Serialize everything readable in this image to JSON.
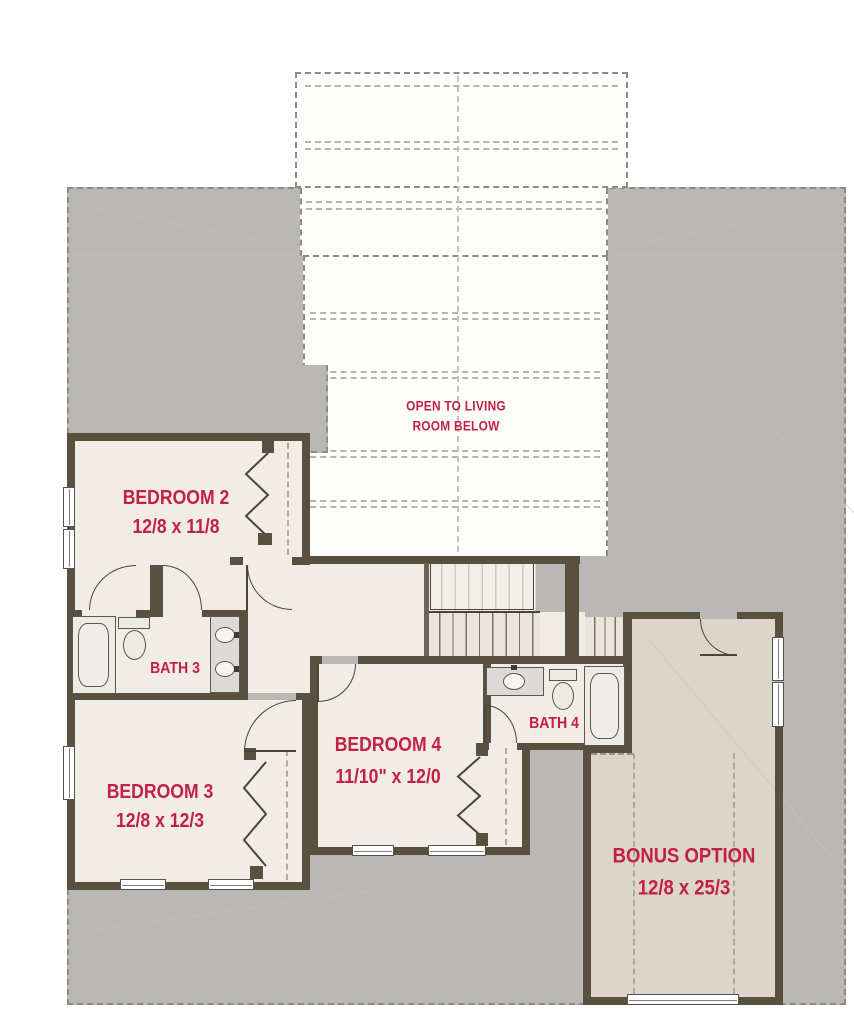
{
  "rooms": {
    "bedroom2": {
      "label": "BEDROOM 2",
      "dimensions": "12/8 x 11/8"
    },
    "bath3": {
      "label": "BATH 3"
    },
    "bedroom3": {
      "label": "BEDROOM 3",
      "dimensions": "12/8 x 12/3"
    },
    "bedroom4": {
      "label": "BEDROOM 4",
      "dimensions": "11/10\" x 12/0"
    },
    "bath4": {
      "label": "BATH 4"
    },
    "bonus": {
      "label": "BONUS OPTION",
      "dimensions": "12/8 x 25/3"
    },
    "open_to_below": {
      "line1": "OPEN TO LIVING",
      "line2": "ROOM BELOW"
    }
  },
  "colors": {
    "accent_red": "#c32044",
    "wall_brown": "#5a503f",
    "roof_gray": "#b9b8b5",
    "floor_beige": "#f1ece6",
    "bonus_greige": "#dcd5c9"
  },
  "icons": {
    "bathtub": "bathtub",
    "toilet": "toilet",
    "sink": "sink",
    "bifold_door": "bifold closet door",
    "door_swing": "door swing arc",
    "window": "window",
    "stairs": "stairs"
  }
}
